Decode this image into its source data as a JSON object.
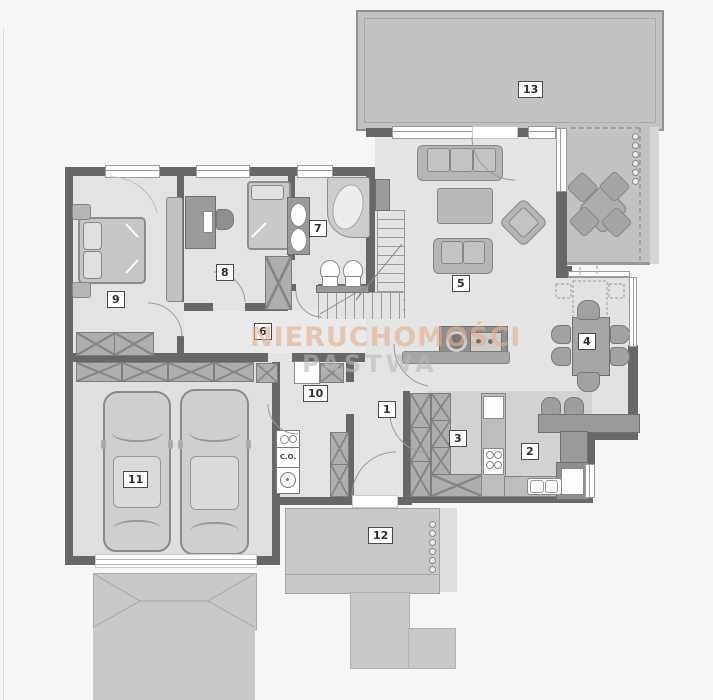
{
  "watermark": {
    "line1": "NIERUCHOMOŚCI",
    "line2": "PASTWA"
  },
  "room_labels": {
    "r1": "1",
    "r2": "2",
    "r3": "3",
    "r4": "4",
    "r5": "5",
    "r6": "6",
    "r7": "7",
    "r8": "8",
    "r9": "9",
    "r10": "10",
    "r11": "11",
    "r12": "12",
    "r13": "13"
  },
  "boiler_label": "C.O.",
  "colors": {
    "wall": "#676767",
    "floor": "#e3e3e3",
    "floor_dark": "#d2d2d2",
    "terrace": "#c2c2c2",
    "paving": "#c9c9c9",
    "furniture": "#b5b5b5",
    "furniture_dark": "#9a9a9a",
    "watermark_peach": "#e0af94",
    "watermark_gray": "#b8b8b8"
  }
}
